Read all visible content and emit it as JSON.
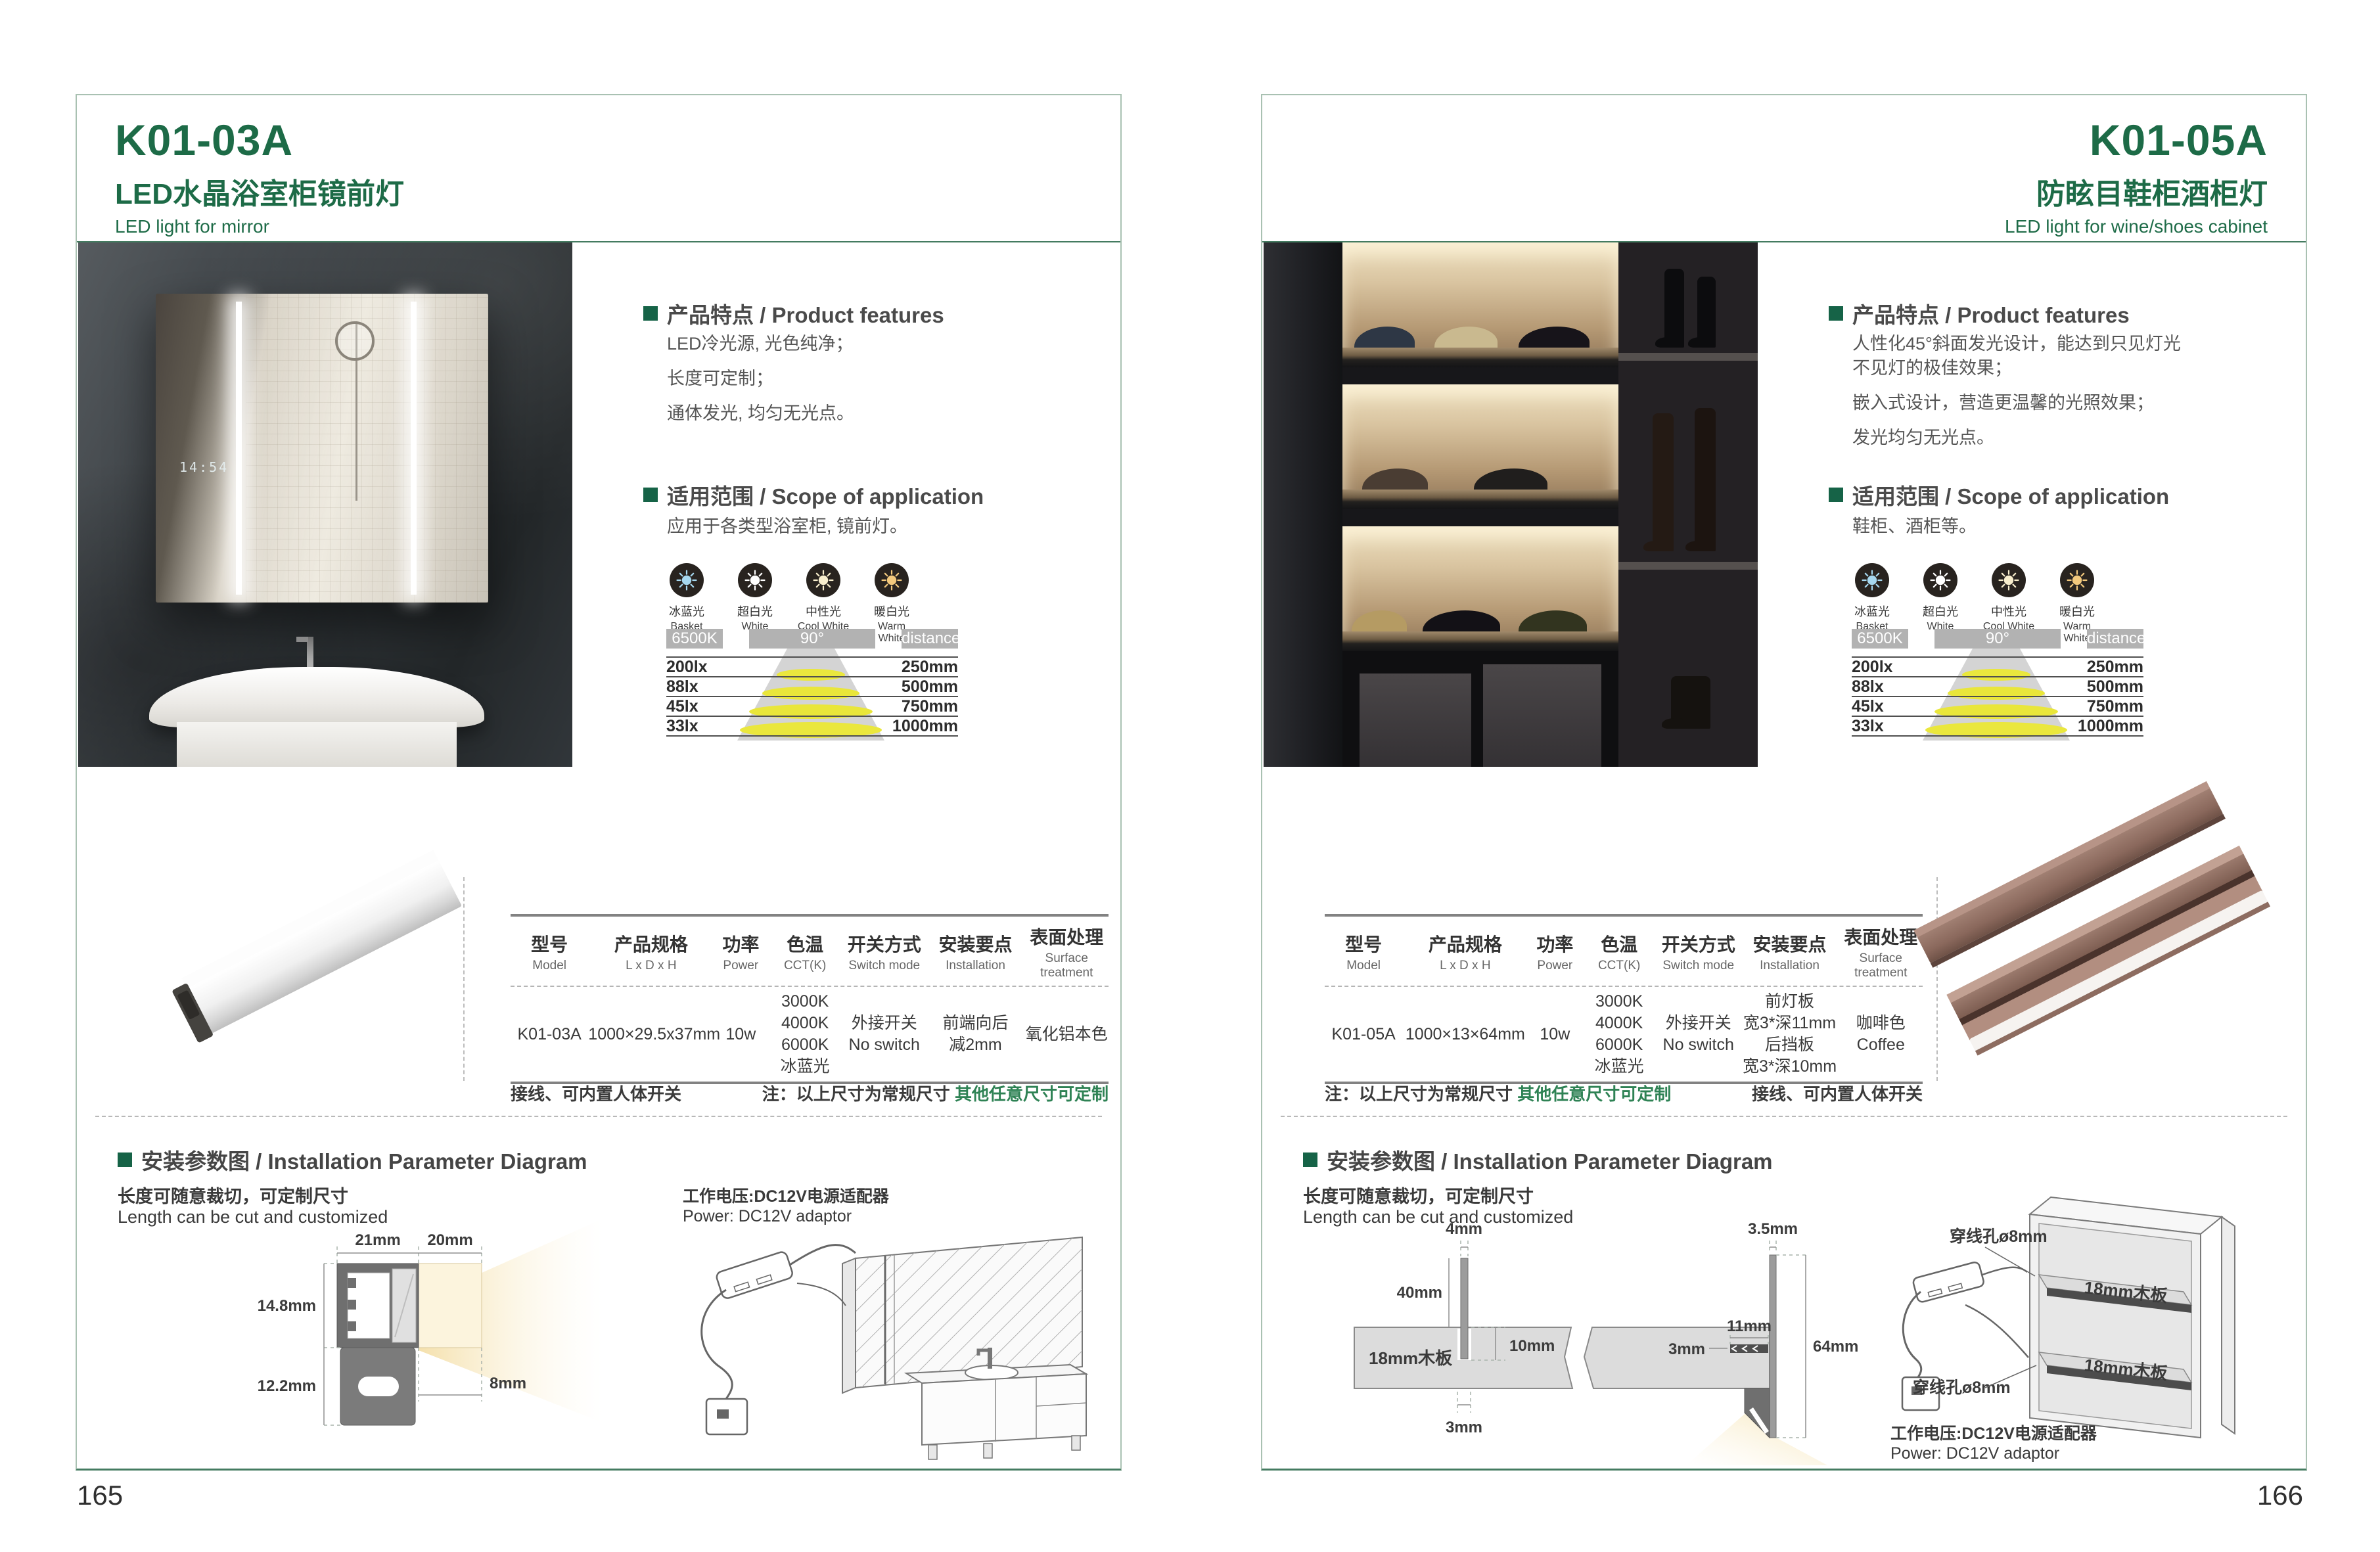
{
  "shared": {
    "labels": {
      "features_heading": "产品特点 / Product features",
      "scope_heading": "适用范围 / Scope of application",
      "install_heading": "安装参数图 / Installation Parameter Diagram",
      "length_note_cn": "长度可随意裁切，可定制尺寸",
      "length_note_en": "Length can be cut and customized",
      "power_note_cn": "工作电压:DC12V电源适配器",
      "power_note_en": "Power: DC12V adaptor",
      "wiring_note": "接线、可内置人体开关",
      "size_note_prefix": "注：以上尺寸为常规尺寸 ",
      "size_note_highlight": "其他任意尺寸可定制"
    },
    "cct_icons": [
      {
        "cn": "冰蓝光",
        "en": "Basket",
        "color": "#a6d8f0"
      },
      {
        "cn": "超白光",
        "en": "White",
        "color": "#ffffff"
      },
      {
        "cn": "中性光",
        "en": "Cool White",
        "color": "#f8eecd"
      },
      {
        "cn": "暖白光",
        "en": "Warm White",
        "color": "#f3c97d"
      }
    ],
    "photometry": {
      "cct": "6500K",
      "angle": "90°",
      "distance_label": "distance",
      "rows": [
        {
          "lux": "200lx",
          "distance": "250mm"
        },
        {
          "lux": "88lx",
          "distance": "500mm"
        },
        {
          "lux": "45lx",
          "distance": "750mm"
        },
        {
          "lux": "33lx",
          "distance": "1000mm"
        }
      ]
    },
    "spec_headers": [
      {
        "cn": "型号",
        "en": "Model"
      },
      {
        "cn": "产品规格",
        "en": "L x D x H"
      },
      {
        "cn": "功率",
        "en": "Power"
      },
      {
        "cn": "色温",
        "en": "CCT(K)"
      },
      {
        "cn": "开关方式",
        "en": "Switch mode"
      },
      {
        "cn": "安装要点",
        "en": "Installation"
      },
      {
        "cn": "表面处理",
        "en": "Surface treatment"
      }
    ]
  },
  "left_page": {
    "model": "K01-03A",
    "title_cn": "LED水晶浴室柜镜前灯",
    "title_en": "LED light for mirror",
    "page_number": "165",
    "mirror_clock": "14:54",
    "features": [
      "LED冷光源, 光色纯净；",
      "长度可定制；",
      "通体发光, 均匀无光点。"
    ],
    "scope_text": "应用于各类型浴室柜, 镜前灯。",
    "spec_row": {
      "model": "K01-03A",
      "size": "1000×29.5x37mm",
      "power": "10w",
      "cct": "3000K\n4000K\n6000K\n冰蓝光",
      "switch": "外接开关\nNo switch",
      "installation": "前端向后\n减2mm",
      "surface": "氧化铝本色"
    },
    "diagram": {
      "d_width": "21mm",
      "d_light": "20mm",
      "d_height": "14.8mm",
      "d_clip": "12.2mm",
      "d_gap": "8mm"
    }
  },
  "right_page": {
    "model": "K01-05A",
    "title_cn": "防眩目鞋柜酒柜灯",
    "title_en": "LED light for wine/shoes cabinet",
    "page_number": "166",
    "features": [
      "人性化45°斜面发光设计，能达到只见灯光\n不见灯的极佳效果；",
      "嵌入式设计，营造更温馨的光照效果；",
      "发光均匀无光点。"
    ],
    "scope_text": "鞋柜、酒柜等。",
    "spec_row": {
      "model": "K01-05A",
      "size": "1000×13×64mm",
      "power": "10w",
      "cct": "3000K\n4000K\n6000K\n冰蓝光",
      "switch": "外接开关\nNo switch",
      "installation": "前灯板\n宽3*深11mm\n后挡板\n宽3*深10mm",
      "surface": "咖啡色\nCoffee"
    },
    "diagram": {
      "d4": "4mm",
      "d35": "3.5mm",
      "d40": "40mm",
      "board": "18mm木板",
      "d10": "10mm",
      "d3_slot": "3mm",
      "d11": "11mm",
      "d3_strip": "3mm",
      "d64": "64mm",
      "hole": "穿线孔ø8mm"
    }
  }
}
